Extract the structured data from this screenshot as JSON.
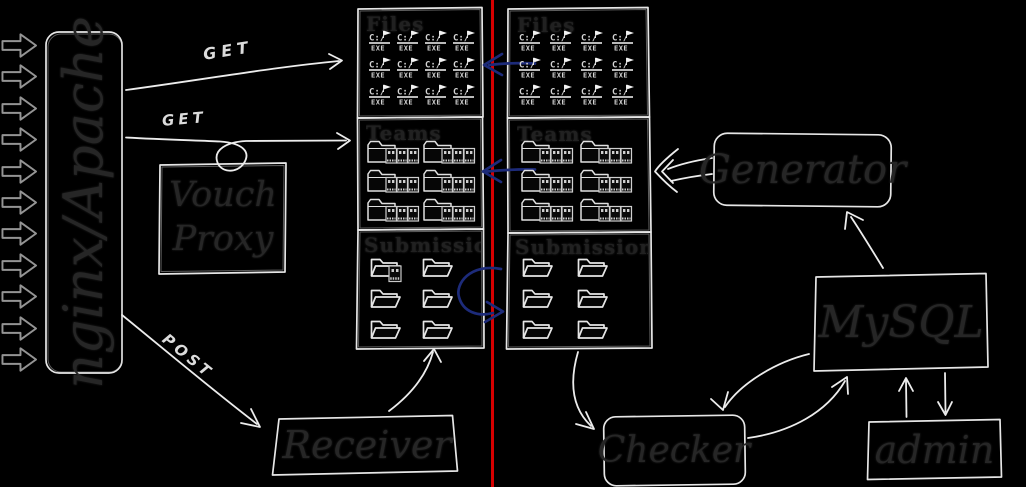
{
  "colors": {
    "background": "#000000",
    "sketch_stroke": "#ececec",
    "dark_text": "#262626",
    "divider_red": "#d60000",
    "sync_blue": "#1d2b7a",
    "icon_gray": "#d4d4d4"
  },
  "nodes": {
    "gateway": {
      "label": "nginx/Apache"
    },
    "vouch": {
      "label": "Vouch Proxy"
    },
    "generator": {
      "label": "Generator"
    },
    "mysql": {
      "label": "MySQL"
    },
    "admin": {
      "label": "admin"
    },
    "checker": {
      "label": "Checker"
    },
    "receiver": {
      "label": "Receiver"
    }
  },
  "panels": {
    "left": {
      "files": {
        "label": "Files",
        "icon": "exe-file-icon",
        "count": 12
      },
      "teams": {
        "label": "Teams",
        "icon": "team-folder-icon",
        "count": 6
      },
      "submissions": {
        "label": "Submissions",
        "icon": "folder-icon",
        "count": 6,
        "extra_icon": "exe-file-mini-icon"
      }
    },
    "right": {
      "files": {
        "label": "Files",
        "icon": "exe-file-icon",
        "count": 12
      },
      "teams": {
        "label": "Teams",
        "icon": "team-folder-icon",
        "count": 6
      },
      "submissions": {
        "label": "Submissions",
        "icon": "folder-icon",
        "count": 6
      }
    }
  },
  "edge_labels": {
    "get_top": "GET",
    "get_bottom": "GET",
    "post": "POST"
  },
  "icons": {
    "exe": {
      "top": "C:/",
      "bottom": "EXE"
    }
  },
  "traffic": {
    "count": 11
  }
}
